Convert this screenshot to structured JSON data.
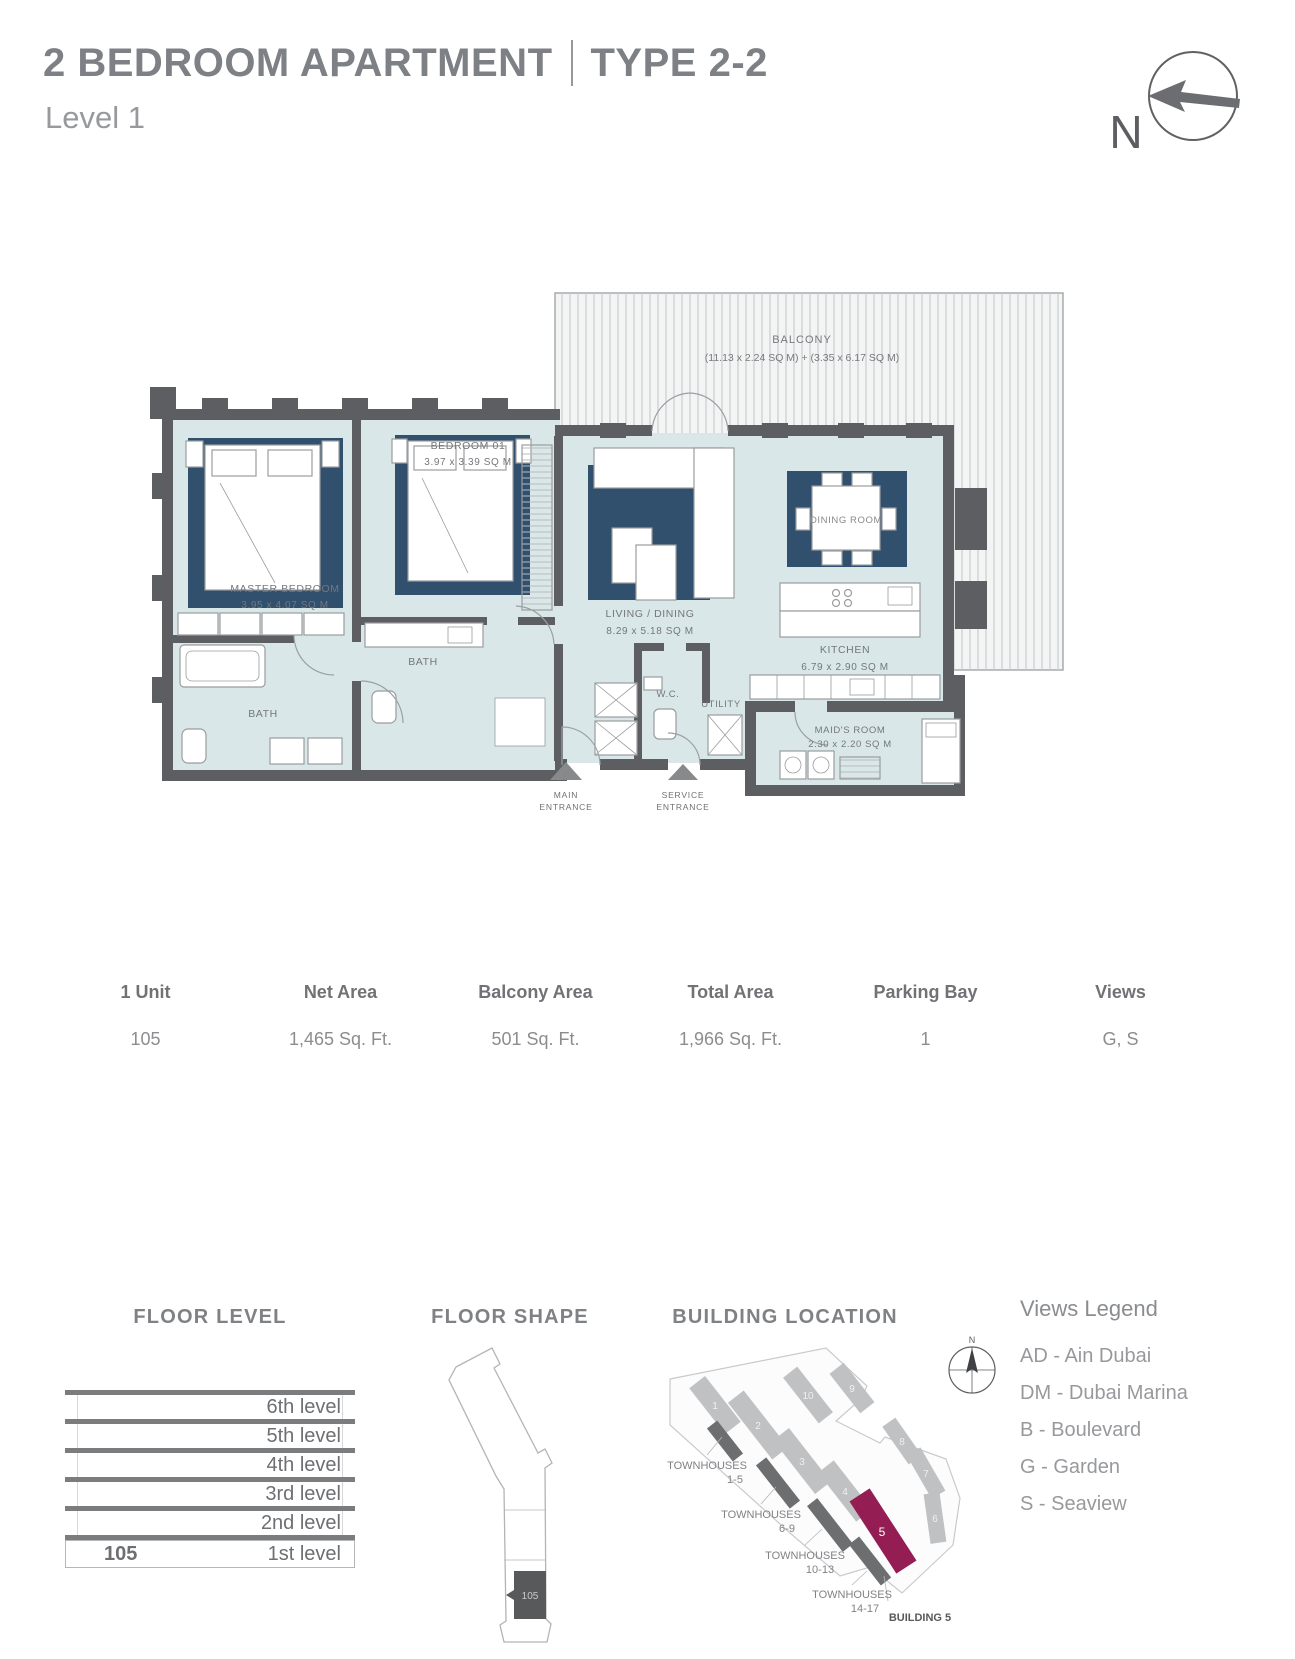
{
  "header": {
    "title_left": "2 BEDROOM APARTMENT",
    "title_right": "TYPE 2-2",
    "subtitle": "Level 1",
    "north_label": "N"
  },
  "floor_plan": {
    "balcony": {
      "label": "BALCONY",
      "dims": "(11.13 x 2.24 SQ M) + (3.35 x 6.17 SQ M)"
    },
    "bedroom01": {
      "label": "BEDROOM 01",
      "dims": "3.97 x 3.39 SQ M"
    },
    "master_bedroom": {
      "label": "MASTER BEDROOM",
      "dims": "3.95 x 4.07 SQ M"
    },
    "master_bath": {
      "label": "BATH"
    },
    "bath2": {
      "label": "BATH"
    },
    "living_dining": {
      "label": "LIVING / DINING",
      "dims": "8.29 x 5.18 SQ M"
    },
    "dining_room": {
      "label": "DINING ROOM"
    },
    "kitchen": {
      "label": "KITCHEN",
      "dims": "6.79 x 2.90 SQ M"
    },
    "wc": {
      "label": "W.C."
    },
    "utility": {
      "label": "UTILITY"
    },
    "maids_room": {
      "label": "MAID'S ROOM",
      "dims": "2.30 x 2.20 SQ M"
    },
    "main_entrance": {
      "line1": "MAIN",
      "line2": "ENTRANCE"
    },
    "service_entrance": {
      "line1": "SERVICE",
      "line2": "ENTRANCE"
    }
  },
  "summary_table": {
    "headers": [
      "1 Unit",
      "Net Area",
      "Balcony Area",
      "Total Area",
      "Parking Bay",
      "Views"
    ],
    "values": [
      "105",
      "1,465 Sq. Ft.",
      "501 Sq. Ft.",
      "1,966 Sq. Ft.",
      "1",
      "G, S"
    ]
  },
  "floor_level": {
    "title": "FLOOR LEVEL",
    "levels": [
      "6th level",
      "5th level",
      "4th level",
      "3rd level",
      "2nd level"
    ],
    "unit": "105",
    "unit_level": "1st level"
  },
  "floor_shape": {
    "title": "FLOOR SHAPE",
    "unit": "105"
  },
  "building_location": {
    "title": "BUILDING LOCATION",
    "compass_n": "N",
    "building_numbers": {
      "b1": "1",
      "b2": "2",
      "b3": "3",
      "b4": "4",
      "b5": "5",
      "b6": "6",
      "b7": "7",
      "b8": "8",
      "b9": "9",
      "b10": "10"
    },
    "townhouses": [
      {
        "line1": "TOWNHOUSES",
        "line2": "1-5"
      },
      {
        "line1": "TOWNHOUSES",
        "line2": "6-9"
      },
      {
        "line1": "TOWNHOUSES",
        "line2": "10-13"
      },
      {
        "line1": "TOWNHOUSES",
        "line2": "14-17"
      }
    ],
    "building5_label": "BUILDING 5"
  },
  "views_legend": {
    "title": "Views Legend",
    "entries": [
      "AD - Ain Dubai",
      "DM - Dubai Marina",
      "B - Boulevard",
      "G - Garden",
      "S - Seaview"
    ]
  },
  "colors": {
    "floor": "#d9e7e9",
    "rug": "#30506e",
    "wall": "#5c5e61",
    "balcony_hatch": "#c9cbcd",
    "highlight_building": "#941e53",
    "townhouse_gray": "#6d6e70",
    "building_gray": "#bfc1c3"
  }
}
